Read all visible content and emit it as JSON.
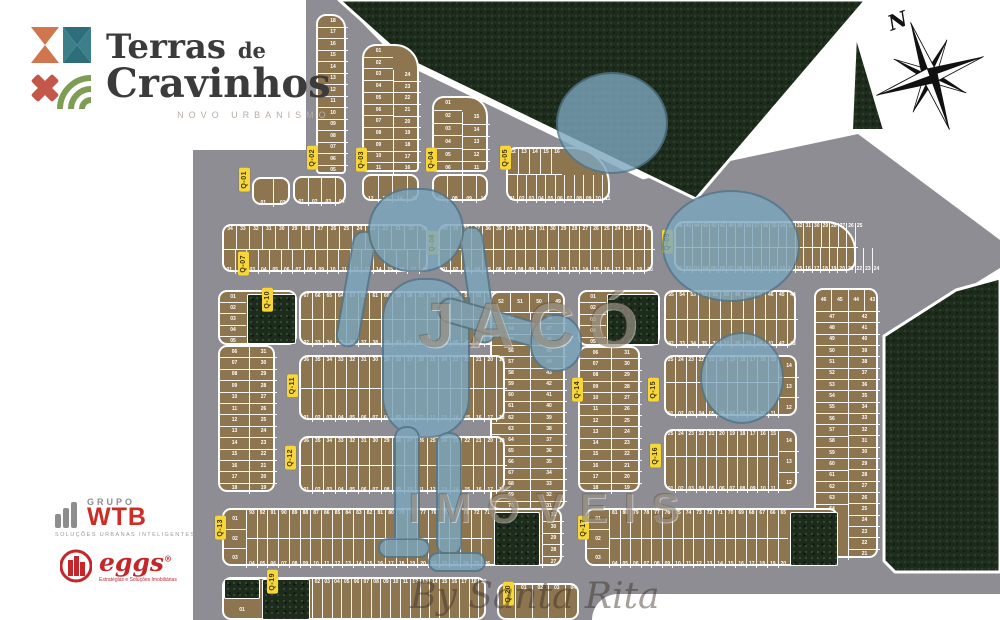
{
  "colors": {
    "forest": "#1d2b1c",
    "road": "#8d8d93",
    "lot": "#8d7550",
    "label_bg": "#f6d63a",
    "label_text": "#403300",
    "wtb_red": "#d02c26",
    "eggs_red": "#c3262b",
    "title_dark": "#3b3b3b",
    "watermark_blue": "#7ca6be"
  },
  "brand": {
    "title_a": "Terras",
    "title_de": "de",
    "title_b": "Cravinhos",
    "tagline": "NOVO URBANISMO"
  },
  "compass": {
    "north": "N"
  },
  "watermark": {
    "big": "JACÓ",
    "mid": "IMÓVEIS",
    "script": "By Santa Rita"
  },
  "partners": {
    "wtb": {
      "group": "GRUPO",
      "name": "WTB",
      "tagline": "SOLUÇÕES URBANAS INTELIGENTES"
    },
    "eggs": {
      "name": "eggs",
      "reg": "®",
      "tagline": "Estratégias e Soluções Imobiliárias"
    }
  },
  "qlabels": [
    {
      "text": "Q-01",
      "x": 239,
      "y": 168
    },
    {
      "text": "Q-02",
      "x": 307,
      "y": 146
    },
    {
      "text": "Q-03",
      "x": 356,
      "y": 148
    },
    {
      "text": "Q-04",
      "x": 426,
      "y": 148
    },
    {
      "text": "Q-05",
      "x": 500,
      "y": 146
    },
    {
      "text": "Q-07",
      "x": 238,
      "y": 252
    },
    {
      "text": "Q-08",
      "x": 427,
      "y": 231
    },
    {
      "text": "Q-09",
      "x": 662,
      "y": 230
    },
    {
      "text": "Q-10",
      "x": 262,
      "y": 288
    },
    {
      "text": "Q-11",
      "x": 287,
      "y": 374
    },
    {
      "text": "Q-12",
      "x": 285,
      "y": 446
    },
    {
      "text": "Q-13",
      "x": 215,
      "y": 516
    },
    {
      "text": "Q-14",
      "x": 572,
      "y": 378
    },
    {
      "text": "Q-15",
      "x": 648,
      "y": 378
    },
    {
      "text": "Q-16",
      "x": 650,
      "y": 444
    },
    {
      "text": "Q-17",
      "x": 578,
      "y": 516
    },
    {
      "text": "Q-19",
      "x": 267,
      "y": 570
    },
    {
      "text": "Q-20",
      "x": 503,
      "y": 582
    }
  ],
  "blocks": [
    {
      "name": "Q-01",
      "x": 252,
      "y": 177,
      "w": 38,
      "h": 28,
      "segs": [
        {
          "t": "h",
          "a": "b",
          "x": 0,
          "y": 0,
          "w": 38,
          "h": 28,
          "cells": "01 02"
        }
      ]
    },
    {
      "name": "Q-02-column",
      "x": 316,
      "y": 14,
      "w": 30,
      "h": 160,
      "r": "10px 14px 4px 4px",
      "segs": [
        {
          "t": "v",
          "x": 0,
          "y": 0,
          "w": 30,
          "h": 160,
          "cells": "18 17 16 15 14 13 12 11 10 09 08 07 06 05"
        }
      ]
    },
    {
      "name": "Q-02-row",
      "x": 293,
      "y": 176,
      "w": 53,
      "h": 28,
      "segs": [
        {
          "t": "h",
          "a": "b",
          "x": 0,
          "y": 0,
          "w": 53,
          "h": 28,
          "cells": "01 02 03 04"
        }
      ]
    },
    {
      "name": "Q-03-column",
      "x": 362,
      "y": 44,
      "w": 57,
      "h": 128,
      "r": "14px 24px 4px 4px",
      "segs": [
        {
          "t": "v",
          "x": 0,
          "y": 0,
          "w": 29,
          "h": 128,
          "cells": "01 02 03 04 05 06 07 08 09 10 11"
        },
        {
          "t": "v",
          "x": 29,
          "y": 24,
          "w": 28,
          "h": 104,
          "d": "l",
          "cells": "24 23 22 21 20 19 18 17 16"
        }
      ]
    },
    {
      "name": "Q-03-row",
      "x": 362,
      "y": 174,
      "w": 57,
      "h": 27,
      "segs": [
        {
          "t": "h",
          "a": "b",
          "x": 0,
          "y": 0,
          "w": 57,
          "h": 27,
          "cells": "12 13 14 15"
        }
      ]
    },
    {
      "name": "Q-04-column",
      "x": 432,
      "y": 96,
      "w": 56,
      "h": 76,
      "r": "12px 20px 4px 4px",
      "segs": [
        {
          "t": "v",
          "x": 0,
          "y": 0,
          "w": 28,
          "h": 76,
          "cells": "01 02 03 04 05 06"
        },
        {
          "t": "v",
          "x": 28,
          "y": 14,
          "w": 28,
          "h": 62,
          "d": "l",
          "cells": "15 14 13 12 11"
        }
      ]
    },
    {
      "name": "Q-04-row",
      "x": 432,
      "y": 174,
      "w": 56,
      "h": 27,
      "segs": [
        {
          "t": "h",
          "a": "b",
          "x": 0,
          "y": 0,
          "w": 56,
          "h": 27,
          "cells": "07 08 09 10"
        }
      ]
    },
    {
      "name": "Q-05",
      "x": 506,
      "y": 147,
      "w": 104,
      "h": 54,
      "r": "10px 38px 10px 10px",
      "segs": [
        {
          "t": "h",
          "a": "t",
          "x": 0,
          "y": 0,
          "w": 54,
          "h": 26,
          "d": "b",
          "cells": "12 13 14 15 16"
        },
        {
          "t": "h",
          "a": "b",
          "x": 0,
          "y": 26,
          "w": 104,
          "h": 28,
          "cells": "01 02 03 04 05 06 07 08 09 10 11"
        }
      ]
    },
    {
      "name": "Q-07",
      "x": 222,
      "y": 224,
      "w": 206,
      "h": 48,
      "segs": [
        {
          "t": "h",
          "a": "t",
          "x": 0,
          "y": 0,
          "w": 206,
          "h": 24,
          "d": "b",
          "cells": "34 33 32 31 30 29 28 27 26 25 24 23 22 21 20 19"
        },
        {
          "t": "h",
          "a": "b",
          "x": 0,
          "y": 24,
          "w": 206,
          "h": 24,
          "cells": "01 02 03 04 05 06 07 08 09 10 11 12 13 14 15 16 17 18"
        }
      ]
    },
    {
      "name": "Q-08",
      "x": 438,
      "y": 224,
      "w": 215,
      "h": 48,
      "segs": [
        {
          "t": "h",
          "a": "t",
          "x": 0,
          "y": 0,
          "w": 215,
          "h": 24,
          "d": "b",
          "cells": "40 39 38 37 36 35 34 33 32 31 30 29 28 27 26 25 24 23 22 21"
        },
        {
          "t": "h",
          "a": "b",
          "x": 0,
          "y": 24,
          "w": 215,
          "h": 24,
          "cells": "01 02 03 04 05 06 07 08 09 10 11 12 13 14 15 16 17 18 19 20"
        }
      ]
    },
    {
      "name": "Q-09",
      "x": 674,
      "y": 221,
      "w": 182,
      "h": 50,
      "r": "10px 30px 10px 10px",
      "segs": [
        {
          "t": "h",
          "a": "t",
          "x": 0,
          "y": 0,
          "w": 182,
          "h": 25,
          "d": "b",
          "cells": "46 45 44 43 42 41 40 39 38 37 36 35 34 33 32 31 30 29 28 27 26 25"
        },
        {
          "t": "h",
          "a": "b",
          "x": 0,
          "y": 25,
          "w": 182,
          "h": 25,
          "cells": "01 02 03 04 05 06 07 08 09 10 11 12 13 14 15 16 17 18 19 20 21 22 23 24"
        }
      ]
    },
    {
      "name": "Q-10-head",
      "x": 218,
      "y": 290,
      "w": 79,
      "h": 55,
      "segs": [
        {
          "t": "v",
          "x": 0,
          "y": 0,
          "w": 26,
          "h": 55,
          "cells": "01 02 03 04 05"
        },
        {
          "t": "g",
          "x": 27,
          "y": 2,
          "w": 49,
          "h": 50
        }
      ]
    },
    {
      "name": "Q-10-columns",
      "x": 218,
      "y": 345,
      "w": 57,
      "h": 147,
      "segs": [
        {
          "t": "v",
          "x": 0,
          "y": 0,
          "w": 29,
          "h": 147,
          "cells": "06 07 08 09 10 11 12 13 14 15 16 17 18"
        },
        {
          "t": "v",
          "x": 29,
          "y": 0,
          "w": 28,
          "h": 147,
          "d": "l",
          "cells": "31 30 29 28 27 26 25 24 23 22 21 20 19"
        }
      ]
    },
    {
      "name": "central-top-rows",
      "x": 299,
      "y": 291,
      "w": 206,
      "h": 54,
      "segs": [
        {
          "t": "h",
          "a": "t",
          "x": 0,
          "y": 0,
          "w": 206,
          "h": 27,
          "d": "b",
          "cells": "67 66 65 64 63 62 61 60 59 58 57 56 55 54 53 52 51 50"
        },
        {
          "t": "h",
          "a": "b",
          "x": 0,
          "y": 27,
          "w": 206,
          "h": 27,
          "cells": "32 33 34 35 36 37 38 39 40 41 42 43 44 45 46 47 48 49"
        }
      ]
    },
    {
      "name": "central-columns",
      "x": 490,
      "y": 291,
      "w": 75,
      "h": 219,
      "segs": [
        {
          "t": "h",
          "a": "c",
          "x": 0,
          "y": 0,
          "w": 75,
          "h": 20,
          "d": "b",
          "cells": "52 51 50 49"
        },
        {
          "t": "v",
          "x": 0,
          "y": 20,
          "w": 38,
          "h": 199,
          "cells": "53 54 55 56 57 58 59 60 61 62 63 64 65 66 67 68 69 70"
        },
        {
          "t": "v",
          "x": 38,
          "y": 20,
          "w": 37,
          "h": 199,
          "d": "l",
          "cells": "48 47 46 45 44 43 42 41 40 39 38 37 36 35 34 33 32 31"
        }
      ]
    },
    {
      "name": "Q-11",
      "x": 299,
      "y": 355,
      "w": 206,
      "h": 65,
      "segs": [
        {
          "t": "h",
          "a": "t",
          "x": 0,
          "y": 0,
          "w": 206,
          "h": 32,
          "d": "b",
          "cells": "36 35 34 33 32 31 30 29 28 27 26 25 24 23 22 21 20 19"
        },
        {
          "t": "h",
          "a": "b",
          "x": 0,
          "y": 32,
          "w": 206,
          "h": 33,
          "cells": "01 02 03 04 05 06 07 08 09 10 11 12 13 14 15 16 17 18"
        }
      ]
    },
    {
      "name": "Q-12",
      "x": 299,
      "y": 436,
      "w": 206,
      "h": 56,
      "segs": [
        {
          "t": "h",
          "a": "t",
          "x": 0,
          "y": 0,
          "w": 206,
          "h": 28,
          "d": "b",
          "cells": "36 35 34 33 32 31 30 29 28 27 26 25 24 23 22 21 20 19"
        },
        {
          "t": "h",
          "a": "b",
          "x": 0,
          "y": 28,
          "w": 206,
          "h": 28,
          "cells": "01 02 03 04 05 06 07 08 09 10 11 12 13 14 15 16 17 18"
        }
      ]
    },
    {
      "name": "Q-14-head",
      "x": 578,
      "y": 290,
      "w": 82,
      "h": 56,
      "segs": [
        {
          "t": "v",
          "x": 0,
          "y": 0,
          "w": 26,
          "h": 56,
          "cells": "01 02 03 04 05"
        },
        {
          "t": "g",
          "x": 27,
          "y": 2,
          "w": 52,
          "h": 51
        }
      ]
    },
    {
      "name": "Q-14-columns",
      "x": 578,
      "y": 346,
      "w": 62,
      "h": 146,
      "segs": [
        {
          "t": "v",
          "x": 0,
          "y": 0,
          "w": 31,
          "h": 146,
          "cells": "06 07 08 09 10 11 12 13 14 15 16 17 18"
        },
        {
          "t": "v",
          "x": 31,
          "y": 0,
          "w": 31,
          "h": 146,
          "d": "l",
          "cells": "31 30 29 28 27 26 25 24 23 22 21 20 19"
        }
      ]
    },
    {
      "name": "Q-15-top-rows",
      "x": 664,
      "y": 290,
      "w": 132,
      "h": 56,
      "segs": [
        {
          "t": "h",
          "a": "t",
          "x": 0,
          "y": 0,
          "w": 132,
          "h": 28,
          "d": "b",
          "cells": "55 54 53 52 51 50 49 48 47 46 45 44"
        },
        {
          "t": "h",
          "a": "b",
          "x": 0,
          "y": 28,
          "w": 132,
          "h": 28,
          "cells": "32 33 34 35 36 37 38 39 40 41 42 43"
        }
      ]
    },
    {
      "name": "Q-15",
      "x": 664,
      "y": 355,
      "w": 133,
      "h": 61,
      "segs": [
        {
          "t": "h",
          "a": "t",
          "x": 0,
          "y": 0,
          "w": 112,
          "h": 26,
          "d": "b",
          "cells": "25 24 23 22 21 20 19 18 17 16 15"
        },
        {
          "t": "h",
          "a": "b",
          "x": 0,
          "y": 26,
          "w": 112,
          "h": 35,
          "cells": "01 02 03 04 05 06 07 08 09 10 11"
        },
        {
          "t": "v",
          "x": 112,
          "y": 0,
          "w": 21,
          "h": 61,
          "d": "l",
          "cells": "14 13 12"
        }
      ]
    },
    {
      "name": "Q-16",
      "x": 664,
      "y": 429,
      "w": 133,
      "h": 62,
      "segs": [
        {
          "t": "h",
          "a": "t",
          "x": 0,
          "y": 0,
          "w": 112,
          "h": 26,
          "d": "b",
          "cells": "25 24 23 22 21 20 19 18 17 16 15"
        },
        {
          "t": "h",
          "a": "b",
          "x": 0,
          "y": 26,
          "w": 112,
          "h": 36,
          "cells": "01 02 03 04 05 06 07 08 09 10 11"
        },
        {
          "t": "v",
          "x": 112,
          "y": 0,
          "w": 21,
          "h": 62,
          "d": "l",
          "cells": "14 13 12"
        }
      ]
    },
    {
      "name": "east-columns",
      "x": 814,
      "y": 288,
      "w": 64,
      "h": 270,
      "segs": [
        {
          "t": "h",
          "a": "c",
          "x": 0,
          "y": 0,
          "w": 64,
          "h": 22,
          "d": "b",
          "cells": "46 45 44 43"
        },
        {
          "t": "v",
          "x": 0,
          "y": 22,
          "w": 32,
          "h": 203,
          "cells": "47 48 49 50 51 52 53 54 55 56 57 58 59 60 61 62 63 64"
        },
        {
          "t": "v",
          "x": 32,
          "y": 22,
          "w": 32,
          "h": 248,
          "d": "l",
          "cells": "42 41 40 39 38 37 36 35 34 33 32 31 30 29 28 27 26 25 24 23 22 21"
        }
      ]
    },
    {
      "name": "Q-13",
      "x": 222,
      "y": 508,
      "w": 340,
      "h": 58,
      "segs": [
        {
          "t": "v",
          "x": 0,
          "y": 0,
          "w": 22,
          "h": 58,
          "cells": "01 02 03"
        },
        {
          "t": "h",
          "a": "t",
          "x": 22,
          "y": 0,
          "w": 246,
          "h": 29,
          "d": "bl",
          "cells": "93 92 91 90 89 88 87 86 85 84 83 82 81 80 79 78 77 76 75 74 73 72 71"
        },
        {
          "t": "h",
          "a": "b",
          "x": 22,
          "y": 29,
          "w": 246,
          "h": 29,
          "d": "l",
          "cells": "04 05 06 07 08 09 10 11 12 13 14 15 16 17 18 19 20 21 22 23 24 25 26"
        },
        {
          "t": "g",
          "x": 270,
          "y": 2,
          "w": 46,
          "h": 54
        },
        {
          "t": "v",
          "x": 318,
          "y": 0,
          "w": 22,
          "h": 58,
          "d": "l",
          "cells": "31 30 29 28 27"
        }
      ]
    },
    {
      "name": "Q-17",
      "x": 585,
      "y": 508,
      "w": 253,
      "h": 58,
      "segs": [
        {
          "t": "v",
          "x": 0,
          "y": 0,
          "w": 22,
          "h": 58,
          "cells": "01 02 03"
        },
        {
          "t": "h",
          "a": "t",
          "x": 22,
          "y": 0,
          "w": 179,
          "h": 29,
          "d": "bl",
          "cells": "81 80 79 78 77 76 75 74 73 72 71 70 69 68 67 66 65"
        },
        {
          "t": "h",
          "a": "b",
          "x": 22,
          "y": 29,
          "w": 179,
          "h": 29,
          "d": "l",
          "cells": "04 05 06 07 08 09 10 11 12 13 14 15 16 17 18 19 20"
        },
        {
          "t": "g",
          "x": 203,
          "y": 2,
          "w": 48,
          "h": 54
        }
      ]
    },
    {
      "name": "Q-19",
      "x": 222,
      "y": 577,
      "w": 264,
      "h": 43,
      "segs": [
        {
          "t": "g",
          "x": 0,
          "y": 0,
          "w": 36,
          "h": 20
        },
        {
          "t": "v",
          "x": 0,
          "y": 20,
          "w": 36,
          "h": 23,
          "cells": "01"
        },
        {
          "t": "g",
          "x": 38,
          "y": 0,
          "w": 48,
          "h": 41
        },
        {
          "t": "h",
          "a": "t",
          "x": 88,
          "y": 0,
          "w": 176,
          "h": 43,
          "d": "l",
          "cells": "02 03 04 05 06 07 08 09 10 11 12 13 14 15 16 17 18 19"
        }
      ]
    },
    {
      "name": "Q-20",
      "x": 497,
      "y": 583,
      "w": 82,
      "h": 37,
      "segs": [
        {
          "t": "h",
          "a": "t",
          "x": 16,
          "y": 0,
          "w": 66,
          "h": 37,
          "d": "l",
          "cells": "01 02 03 04"
        }
      ]
    }
  ]
}
